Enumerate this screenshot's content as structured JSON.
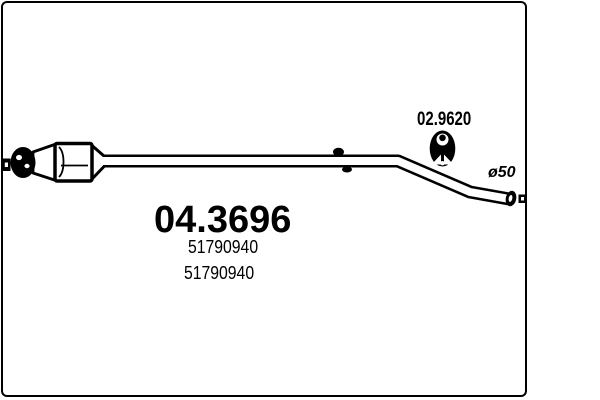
{
  "canvas": {
    "background": "#ffffff",
    "ink_color": "#000000"
  },
  "frame": {
    "border_color": "#000000"
  },
  "labels": {
    "hanger_code": "02.9620",
    "pipe_diameter": "ø50",
    "part_number": "04.3696",
    "oe_numbers": [
      "51790940",
      "51790940"
    ]
  },
  "drawing": {
    "subject": "exhaust-middle-pipe-with-catalytic-converter",
    "parts": [
      "inlet-flange",
      "ball-joint",
      "inlet-cone",
      "catalytic-converter-body",
      "outlet-cone",
      "exhaust-pipe",
      "weld-boss",
      "rubber-hanger",
      "pipe-end-cap",
      "mounting-bracket"
    ]
  }
}
